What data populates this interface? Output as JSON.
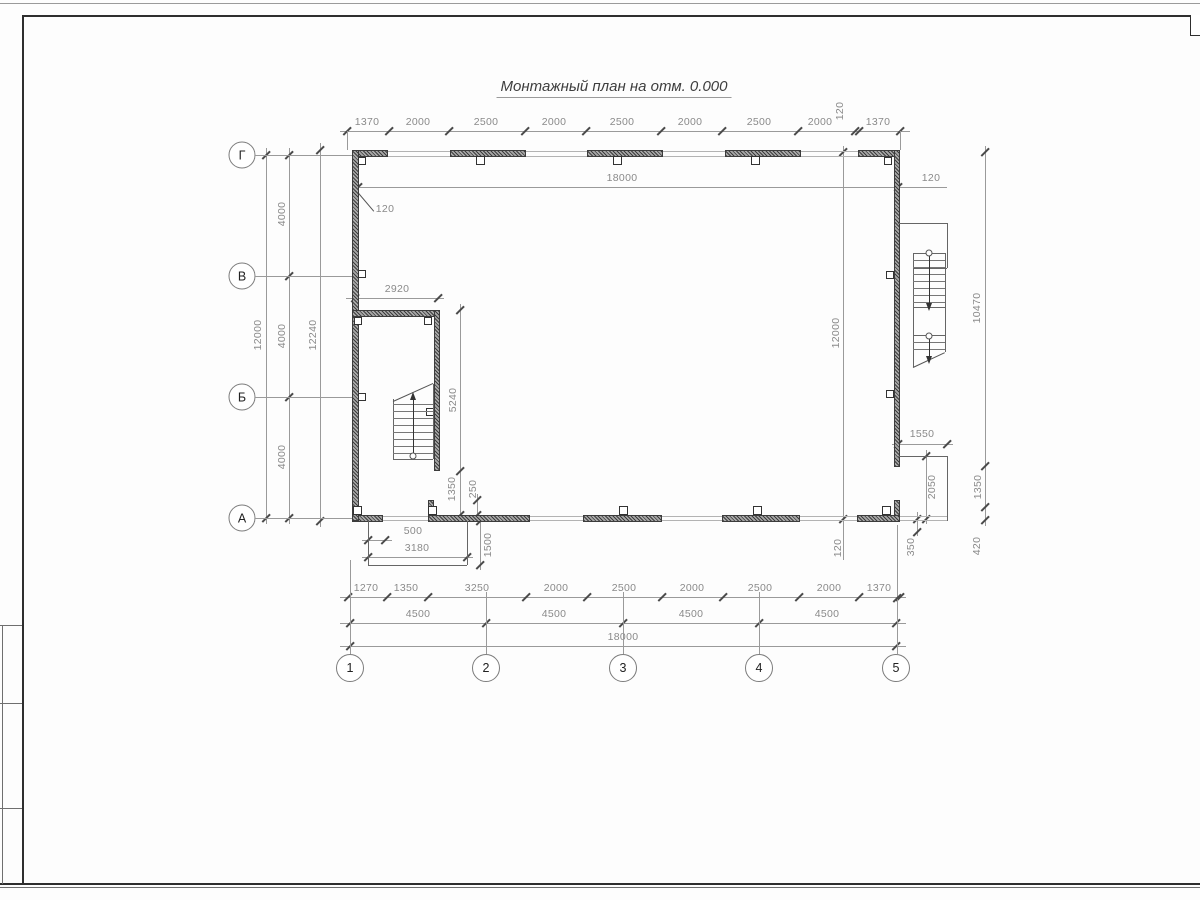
{
  "title": "Монтажный план на отм. 0.000",
  "axis_circles": {
    "left": [
      {
        "label": "Г",
        "cx": 242,
        "cy": 155
      },
      {
        "label": "В",
        "cx": 242,
        "cy": 276
      },
      {
        "label": "Б",
        "cx": 242,
        "cy": 397
      },
      {
        "label": "А",
        "cx": 242,
        "cy": 518
      }
    ],
    "bottom": [
      {
        "label": "1",
        "cx": 350,
        "cy": 668
      },
      {
        "label": "2",
        "cx": 486,
        "cy": 668
      },
      {
        "label": "3",
        "cx": 623,
        "cy": 668
      },
      {
        "label": "4",
        "cx": 759,
        "cy": 668
      },
      {
        "label": "5",
        "cx": 896,
        "cy": 668
      }
    ]
  },
  "h_dims": [
    {
      "name": "top-chain",
      "y": 131,
      "x1": 340,
      "x2": 910,
      "ticks": [
        347,
        388.5,
        449,
        525,
        585.5,
        661,
        722,
        797.5,
        855,
        859,
        900
      ],
      "labels": [
        {
          "t": "1370",
          "x": 367,
          "y": 122
        },
        {
          "t": "2000",
          "x": 418,
          "y": 122
        },
        {
          "t": "2500",
          "x": 486,
          "y": 122
        },
        {
          "t": "2000",
          "x": 554,
          "y": 122
        },
        {
          "t": "2500",
          "x": 622,
          "y": 122
        },
        {
          "t": "2000",
          "x": 690,
          "y": 122
        },
        {
          "t": "2500",
          "x": 759,
          "y": 122
        },
        {
          "t": "2000",
          "x": 820,
          "y": 122
        },
        {
          "t": "120",
          "x": 840,
          "y": 111,
          "rot": true
        },
        {
          "t": "1370",
          "x": 878,
          "y": 122
        }
      ]
    },
    {
      "name": "inner-18000",
      "y": 187,
      "x1": 358,
      "x2": 947,
      "ticks": [
        358,
        898
      ],
      "labels": [
        {
          "t": "18000",
          "x": 622,
          "y": 178
        },
        {
          "t": "120",
          "x": 931,
          "y": 178
        }
      ]
    },
    {
      "name": "stairwell-2920",
      "y": 298,
      "x1": 346,
      "x2": 444,
      "ticks": [
        355,
        438
      ],
      "labels": [
        {
          "t": "2920",
          "x": 397,
          "y": 289
        }
      ]
    },
    {
      "name": "notch-1550",
      "y": 444,
      "x1": 892,
      "x2": 953,
      "ticks": [
        898,
        947
      ],
      "labels": [
        {
          "t": "1550",
          "x": 922,
          "y": 434
        }
      ]
    },
    {
      "name": "porch-500",
      "y": 540,
      "x1": 362,
      "x2": 392,
      "ticks": [
        368,
        385
      ],
      "labels": [
        {
          "t": "500",
          "x": 413,
          "y": 531
        }
      ]
    },
    {
      "name": "porch-3180",
      "y": 557,
      "x1": 362,
      "x2": 473,
      "ticks": [
        368,
        467
      ],
      "labels": [
        {
          "t": "3180",
          "x": 417,
          "y": 548
        }
      ]
    },
    {
      "name": "bottom-chain-1",
      "y": 597,
      "x1": 340,
      "x2": 906,
      "ticks": [
        348,
        386.5,
        427.5,
        526,
        586.5,
        662,
        723,
        798.5,
        859,
        900
      ],
      "labels": [
        {
          "t": "1270",
          "x": 366,
          "y": 588
        },
        {
          "t": "1350",
          "x": 406,
          "y": 588
        },
        {
          "t": "3250",
          "x": 477,
          "y": 588
        },
        {
          "t": "2000",
          "x": 556,
          "y": 588
        },
        {
          "t": "2500",
          "x": 624,
          "y": 588
        },
        {
          "t": "2000",
          "x": 692,
          "y": 588
        },
        {
          "t": "2500",
          "x": 760,
          "y": 588
        },
        {
          "t": "2000",
          "x": 829,
          "y": 588
        },
        {
          "t": "1370",
          "x": 879,
          "y": 588
        }
      ]
    },
    {
      "name": "bottom-chain-4500",
      "y": 623,
      "x1": 340,
      "x2": 906,
      "ticks": [
        350,
        486,
        623,
        759,
        896
      ],
      "labels": [
        {
          "t": "4500",
          "x": 418,
          "y": 614
        },
        {
          "t": "4500",
          "x": 554,
          "y": 614
        },
        {
          "t": "4500",
          "x": 691,
          "y": 614
        },
        {
          "t": "4500",
          "x": 827,
          "y": 614
        }
      ]
    },
    {
      "name": "bottom-18000",
      "y": 646,
      "x1": 340,
      "x2": 906,
      "ticks": [
        350,
        896
      ],
      "labels": [
        {
          "t": "18000",
          "x": 623,
          "y": 637
        }
      ]
    }
  ],
  "v_dims": [
    {
      "name": "left-12000",
      "x": 266,
      "y1": 148,
      "y2": 524,
      "ticks": [
        155,
        518
      ],
      "labels": [
        {
          "t": "12000",
          "x": 258,
          "y": 335,
          "rot": true
        }
      ]
    },
    {
      "name": "left-4000",
      "x": 289,
      "y1": 148,
      "y2": 524,
      "ticks": [
        155,
        276,
        397,
        518
      ],
      "labels": [
        {
          "t": "4000",
          "x": 282,
          "y": 214,
          "rot": true
        },
        {
          "t": "4000",
          "x": 282,
          "y": 336,
          "rot": true
        },
        {
          "t": "4000",
          "x": 282,
          "y": 457,
          "rot": true
        }
      ]
    },
    {
      "name": "left-12240",
      "x": 320,
      "y1": 143,
      "y2": 527,
      "ticks": [
        150,
        521
      ],
      "labels": [
        {
          "t": "12240",
          "x": 313,
          "y": 335,
          "rot": true
        }
      ]
    },
    {
      "name": "stairwell-5240-1350",
      "x": 460,
      "y1": 304,
      "y2": 521,
      "ticks": [
        310,
        471,
        515
      ],
      "labels": [
        {
          "t": "5240",
          "x": 453,
          "y": 400,
          "rot": true
        },
        {
          "t": "1350",
          "x": 452,
          "y": 489,
          "rot": true
        }
      ]
    },
    {
      "name": "stair-250",
      "x": 477,
      "y1": 494,
      "y2": 521,
      "ticks": [
        500,
        515
      ],
      "labels": [
        {
          "t": "250",
          "x": 473,
          "y": 489,
          "rot": true
        }
      ]
    },
    {
      "name": "porch-1500",
      "x": 480,
      "y1": 516,
      "y2": 570,
      "ticks": [
        521,
        565
      ],
      "labels": [
        {
          "t": "1500",
          "x": 488,
          "y": 545,
          "rot": true
        }
      ]
    },
    {
      "name": "right-inner-12000",
      "x": 843,
      "y1": 146,
      "y2": 560,
      "ticks": [
        152,
        519
      ],
      "labels": [
        {
          "t": "12000",
          "x": 836,
          "y": 333,
          "rot": true
        },
        {
          "t": "120",
          "x": 838,
          "y": 548,
          "rot": true
        }
      ]
    },
    {
      "name": "notch-2050",
      "x": 926,
      "y1": 450,
      "y2": 524,
      "ticks": [
        456,
        519
      ],
      "labels": [
        {
          "t": "2050",
          "x": 932,
          "y": 487,
          "rot": true
        }
      ]
    },
    {
      "name": "notch-350",
      "x": 917,
      "y1": 512,
      "y2": 536,
      "ticks": [
        519,
        532
      ],
      "labels": [
        {
          "t": "350",
          "x": 911,
          "y": 547,
          "rot": true
        }
      ]
    },
    {
      "name": "right-outer",
      "x": 985,
      "y1": 146,
      "y2": 526,
      "ticks": [
        152,
        466,
        507,
        520
      ],
      "labels": [
        {
          "t": "10470",
          "x": 977,
          "y": 308,
          "rot": true
        },
        {
          "t": "1350",
          "x": 978,
          "y": 487,
          "rot": true
        },
        {
          "t": "420",
          "x": 977,
          "y": 546,
          "rot": true
        }
      ]
    }
  ],
  "leader_label": {
    "t": "120",
    "x": 385,
    "y": 209
  }
}
